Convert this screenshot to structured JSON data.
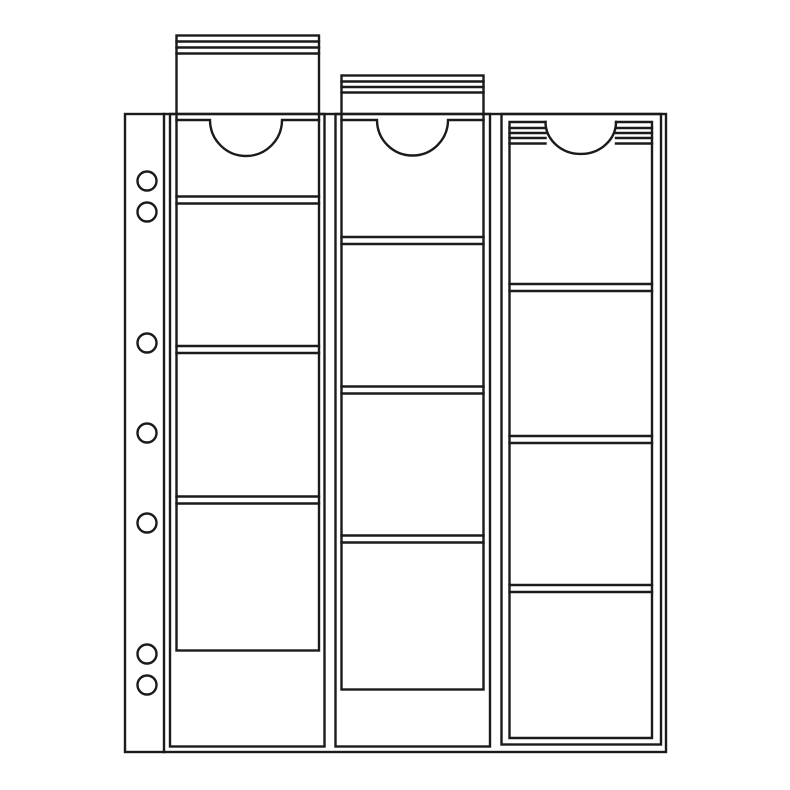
{
  "illustration": {
    "title": "coin-pocket-album-sheet-line-drawing",
    "background_color": "#ffffff",
    "line_color": "#1b1b1b",
    "line_width": 2.4,
    "canvas": {
      "width": 790,
      "height": 790
    },
    "sheet": {
      "x1": 125,
      "y1": 114,
      "x2": 666,
      "y2": 752,
      "margin_divider_x": 164
    },
    "binder_holes": {
      "cx": 147,
      "radius": 9.5,
      "cy": [
        181,
        212,
        343,
        433,
        523,
        654,
        685
      ]
    },
    "strips": [
      {
        "outer": [
          170,
          114,
          324.5,
          746.5
        ],
        "card": [
          176.5,
          35.5,
          319,
          650.5
        ],
        "stripes": {
          "y": [
            41.5,
            47.5,
            53.5
          ],
          "x1": 176.5,
          "x2": 319
        },
        "pocket_top": {
          "style": "inline",
          "y": 120,
          "x1": 176.5,
          "x2": 319,
          "notch_x1": 210,
          "notch_x2": 282,
          "notch_ry": 36
        },
        "dividers": {
          "x1": 176.5,
          "x2": 319,
          "pairs": [
            [
              196.5,
              203.5
            ],
            [
              346,
              353
            ],
            [
              496.5,
              503.5
            ]
          ]
        }
      },
      {
        "outer": [
          335.5,
          114,
          490,
          746.5
        ],
        "card": [
          341.5,
          75.5,
          483.5,
          689.5
        ],
        "stripes": {
          "y": [
            81.5,
            87,
            92.5
          ],
          "x1": 341.5,
          "x2": 483.5
        },
        "pocket_top": {
          "style": "inline",
          "y": 120,
          "x1": 341.5,
          "x2": 483.5,
          "notch_x1": 377,
          "notch_x2": 448,
          "notch_ry": 35.5
        },
        "dividers": {
          "x1": 341.5,
          "x2": 483.5,
          "pairs": [
            [
              237,
              244
            ],
            [
              386.5,
              393.5
            ],
            [
              535.5,
              542.5
            ]
          ]
        }
      },
      {
        "outer": [
          501.5,
          114,
          661,
          744.5
        ],
        "inner": [
          509.5,
          122,
          652,
          738
        ],
        "stripes": {
          "y": [
            128,
            133,
            138,
            143.5
          ],
          "x1": 509.5,
          "x2": 652
        },
        "pocket_top": {
          "style": "cutout",
          "y": 122,
          "x1": 509.5,
          "x2": 652,
          "notch_x1": 545.5,
          "notch_x2": 616,
          "notch_ry": 32
        },
        "dividers": {
          "x1": 509.5,
          "x2": 652,
          "pairs": [
            [
              284,
              291
            ],
            [
              436,
              443
            ],
            [
              585,
              592
            ]
          ]
        }
      }
    ]
  }
}
